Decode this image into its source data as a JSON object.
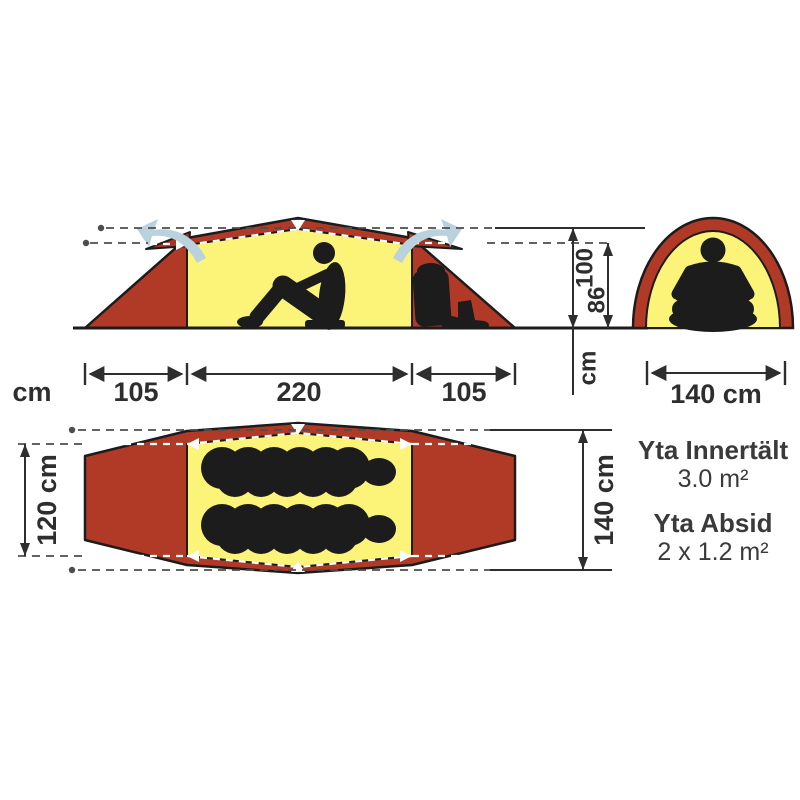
{
  "side_view": {
    "height_total": "100",
    "height_inner": "86",
    "height_unit": "cm",
    "width_unit": "cm",
    "width_left": "105",
    "width_center": "220",
    "width_right": "105"
  },
  "front_view": {
    "width": "140 cm"
  },
  "top_view": {
    "inner_width": "120 cm",
    "outer_width": "140 cm"
  },
  "info": {
    "inner_area_label": "Yta Innertält",
    "inner_area_value": "3.0 m²",
    "vestibule_area_label": "Yta Absid",
    "vestibule_area_value": "2 x 1.2 m²"
  },
  "colors": {
    "fly_red": "#b13a27",
    "vent_hood_red": "#a83524",
    "inner_yellow": "#fcf478",
    "silhouette": "#1c1c1c",
    "vent_arrow_blue": "#b9d2dd",
    "dimension_line": "#2e2e2e",
    "guide_gray": "#4d4d4d",
    "text": "#3a3a3a"
  }
}
